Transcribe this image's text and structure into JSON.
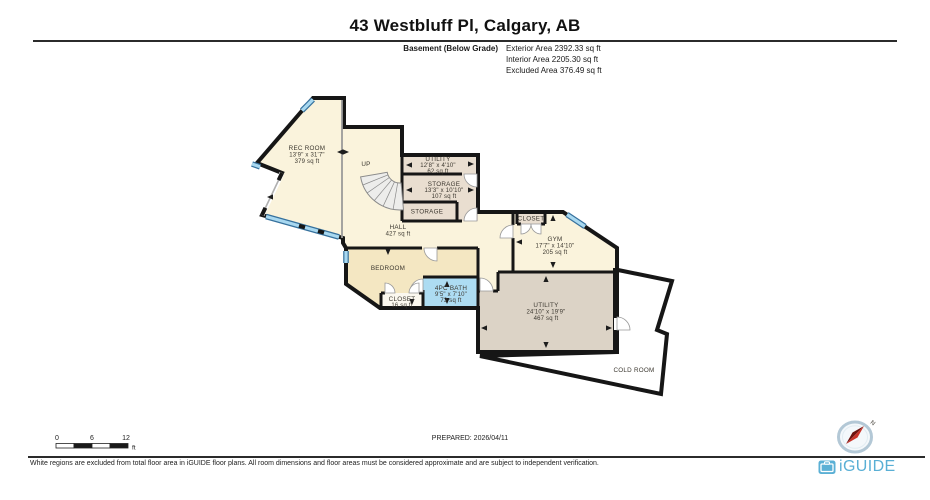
{
  "header": {
    "title": "43 Westbluff Pl, Calgary, AB",
    "floor_label": "Basement (Below Grade)",
    "exterior_area": "Exterior Area 2392.33 sq ft",
    "interior_area": "Interior Area 2205.30 sq ft",
    "excluded_area": "Excluded Area 376.49 sq ft"
  },
  "plan": {
    "stairs_label": "UP",
    "rooms": {
      "rec_room": {
        "name": "REC ROOM",
        "dims": "13'9\" x 31'7\"",
        "area": "379 sq ft"
      },
      "utility_small": {
        "name": "UTILITY",
        "dims": "12'8\" x 4'10\"",
        "area": "62 sq ft"
      },
      "storage": {
        "name": "STORAGE",
        "dims": "13'3\" x 10'10\"",
        "area": "107 sq ft"
      },
      "storage_closet": {
        "name": "STORAGE"
      },
      "hall": {
        "name": "HALL",
        "area": "427 sq ft"
      },
      "closet_gym": {
        "name": "CLOSET"
      },
      "gym": {
        "name": "GYM",
        "dims": "17'7\" x 14'10\"",
        "area": "205 sq ft"
      },
      "bedroom": {
        "name": "BEDROOM"
      },
      "closet_bedroom": {
        "name": "CLOSET",
        "area": "16 sq ft"
      },
      "bath": {
        "name": "4PC BATH",
        "dims": "9'5\" x 7'10\"",
        "area": "73 sq ft"
      },
      "utility_big": {
        "name": "UTILITY",
        "dims": "24'10\" x 19'9\"",
        "area": "467 sq ft"
      },
      "cold_room": {
        "name": "COLD ROOM"
      }
    }
  },
  "scale_bar": {
    "t0": "0",
    "t1": "6",
    "t2": "12",
    "unit": "ft"
  },
  "prepared": "PREPARED: 2026/04/11",
  "compass": {
    "north": "N"
  },
  "footer": {
    "disclaimer": "White regions are excluded from total floor area in iGUIDE floor plans. All room dimensions and floor areas must be considered approximate and are subject to independent verification.",
    "brand": "iGUIDE"
  }
}
